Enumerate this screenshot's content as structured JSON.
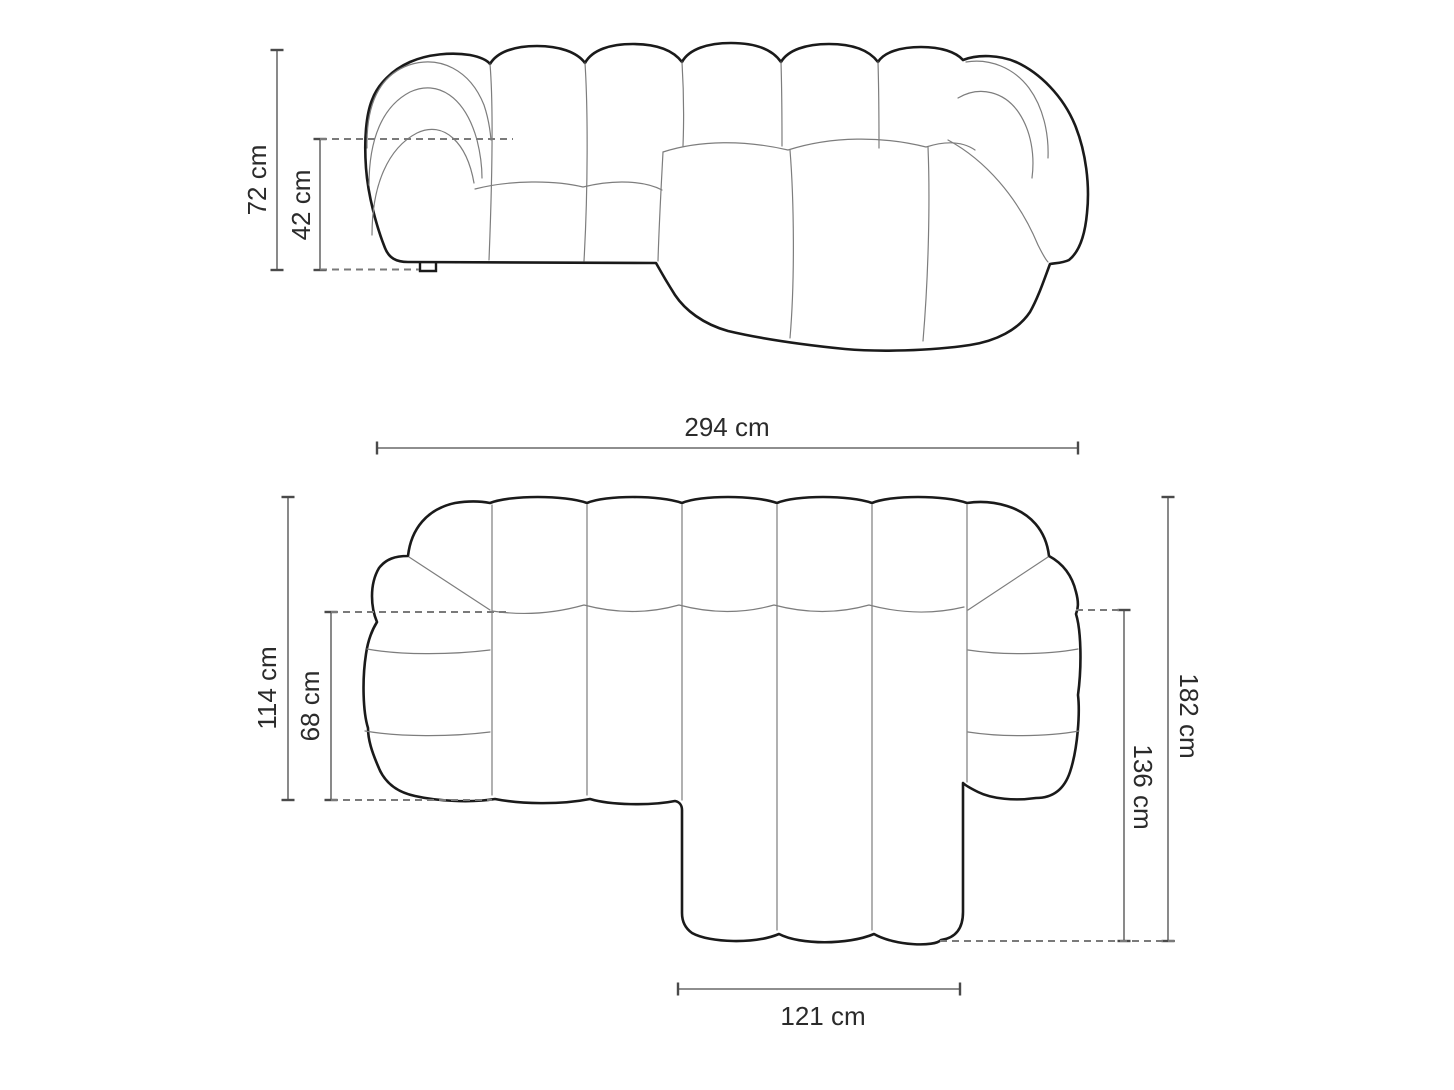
{
  "diagram": {
    "unit": "cm",
    "front_view": {
      "dims": {
        "total_height": {
          "label": "72 cm",
          "value": 72
        },
        "seat_height": {
          "label": "42 cm",
          "value": 42
        }
      }
    },
    "top_view": {
      "dims": {
        "total_width": {
          "label": "294 cm",
          "value": 294
        },
        "left_depth": {
          "label": "114 cm",
          "value": 114
        },
        "seat_depth": {
          "label": "68 cm",
          "value": 68
        },
        "total_depth": {
          "label": "182 cm",
          "value": 182
        },
        "chaise_depth": {
          "label": "136 cm",
          "value": 136
        },
        "chaise_width": {
          "label": "121 cm",
          "value": 121
        }
      }
    },
    "colors": {
      "outline": "#1a1a1a",
      "seam": "#7d7d7d",
      "dimension": "#4a4a4a",
      "dashed": "#7a7a7a",
      "label": "#2b2b2b",
      "background": "#ffffff"
    }
  }
}
